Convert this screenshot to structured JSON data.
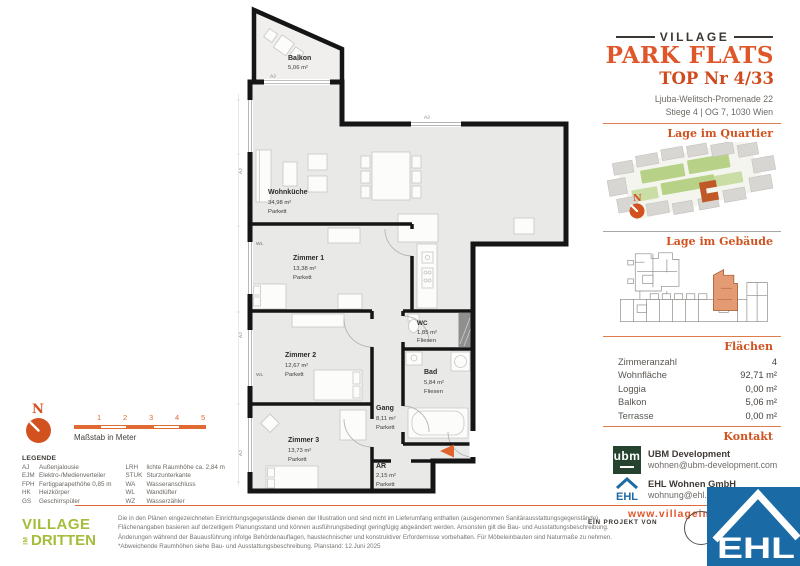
{
  "header": {
    "brand_top": "VILLAGE",
    "brand_main": "PARK FLATS",
    "unit_title": "TOP Nr 4/33",
    "address_line1": "Ljuba-Welitsch-Promenade 22",
    "address_line2": "Stiege 4 | OG 7, 1030 Wien"
  },
  "sections": {
    "quartier": "Lage im Quartier",
    "gebaeude": "Lage im Gebäude",
    "flaechen": "Flächen",
    "kontakt": "Kontakt"
  },
  "compass": {
    "label": "N"
  },
  "scalebar": {
    "ticks": [
      "1",
      "2",
      "3",
      "4",
      "5"
    ],
    "label": "Maßstab in Meter"
  },
  "plan": {
    "rooms": [
      {
        "name": "Balkon",
        "area": "5,06 m²",
        "floor": ""
      },
      {
        "name": "Wohnküche",
        "area": "34,98 m²",
        "floor": "Parkett"
      },
      {
        "name": "Zimmer 1",
        "area": "13,38 m²",
        "floor": "Parkett"
      },
      {
        "name": "Zimmer 2",
        "area": "12,67 m²",
        "floor": "Parkett"
      },
      {
        "name": "Zimmer 3",
        "area": "13,73 m²",
        "floor": "Parkett"
      },
      {
        "name": "WC",
        "area": "1,85 m²",
        "floor": "Fliesen"
      },
      {
        "name": "Bad",
        "area": "5,84 m²",
        "floor": "Fliesen"
      },
      {
        "name": "Gang",
        "area": "8,11 m²",
        "floor": "Parkett"
      },
      {
        "name": "AR",
        "area": "2,15 m²",
        "floor": "Parkett"
      }
    ],
    "labels": {
      "aj": "AJ",
      "wl": "WL"
    }
  },
  "areas": {
    "rows": [
      {
        "label": "Zimmeranzahl",
        "value": "4"
      },
      {
        "label": "Wohnfläche",
        "value": "92,71 m²"
      },
      {
        "label": "Loggia",
        "value": "0,00 m²"
      },
      {
        "label": "Balkon",
        "value": "5,06 m²"
      },
      {
        "label": "Terrasse",
        "value": "0,00 m²"
      }
    ]
  },
  "contact": {
    "ubm": {
      "logo_text": "ubm",
      "name": "UBM Development",
      "email": "wohnen@ubm-development.com"
    },
    "ehl": {
      "logo_text": "EHL",
      "name": "EHL Wohnen GmbH",
      "email": "wohnung@ehl.at"
    },
    "website": "www.villageimdritten.at"
  },
  "legend": {
    "title": "LEGENDE",
    "col1": [
      {
        "abbr": "AJ",
        "text": "Außenjalousie"
      },
      {
        "abbr": "EJM",
        "text": "Elektro-/Medienverteiler"
      },
      {
        "abbr": "FPH",
        "text": "Fertigparapethöhe 0,85 m"
      },
      {
        "abbr": "HK",
        "text": "Heizkörper"
      },
      {
        "abbr": "GS",
        "text": "Geschirrspüler"
      }
    ],
    "col2": [
      {
        "abbr": "LRH",
        "text": "lichte Raumhöhe ca. 2,84 m"
      },
      {
        "abbr": "STUK",
        "text": "Sturzunterkante"
      },
      {
        "abbr": "WA",
        "text": "Wasseranschluss"
      },
      {
        "abbr": "WL",
        "text": "Wandlüfter"
      },
      {
        "abbr": "WZ",
        "text": "Wasserzähler"
      }
    ]
  },
  "footer": {
    "logo_line1": "VILLAGE",
    "logo_im": "IM",
    "logo_line2": "DRITTEN",
    "project_by": "EIN PROJEKT VON",
    "ehl_logo_text": "EHL",
    "disclaimer": "Die in den Plänen eingezeichneten Einrichtungsgegenstände dienen der Illustration und sind nicht im Lieferumfang enthalten (ausgenommen Sanitärausstattungsgegenstände). Flächenangaben basieren auf derzeitigem Planungsstand und können ausführungsbedingt geringfügig abgeändert werden. Ansonsten gilt die Bau- und Ausstattungsbeschreibung. Änderungen während der Bauausführung infolge Behördenauflagen, haustechnischer und konstruktiver Erfordernisse vorbehalten. Für Möbeleinbauten sind Naturmaße zu nehmen. *Abweichende Raumhöhen siehe Bau- und Ausstattungsbeschreibung. Planstand: 12.Juni 2025"
  },
  "colors": {
    "accent_orange": "#e0562b",
    "section_orange": "#d0521f",
    "logo_green": "#a4bd3a",
    "ubm_green": "#25432f",
    "ehl_blue": "#1a6aa5",
    "wall_black": "#151515",
    "room_fill": "#e9e9e8",
    "highlight_unit": "#e49a73"
  }
}
